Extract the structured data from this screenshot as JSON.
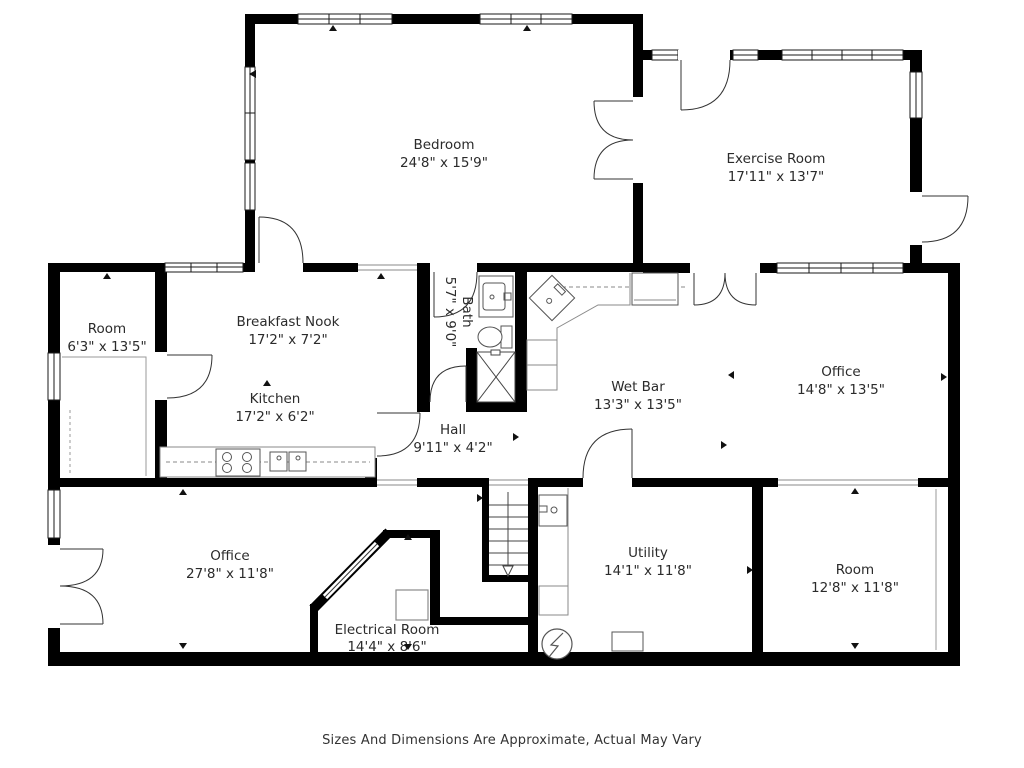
{
  "footer": {
    "disclaimer": "Sizes And Dimensions Are Approximate, Actual May Vary"
  },
  "rooms": {
    "bedroom": {
      "name": "Bedroom",
      "dims": "24'8\" x 15'9\""
    },
    "exercise_room": {
      "name": "Exercise Room",
      "dims": "17'11\" x 13'7\""
    },
    "room_left": {
      "name": "Room",
      "dims": "6'3\" x 13'5\""
    },
    "breakfast_nook": {
      "name": "Breakfast Nook",
      "dims": "17'2\" x 7'2\""
    },
    "kitchen": {
      "name": "Kitchen",
      "dims": "17'2\" x 6'2\""
    },
    "bath": {
      "name": "Bath",
      "dims": "5'7\" x 9'0\""
    },
    "wet_bar": {
      "name": "Wet Bar",
      "dims": "13'3\" x 13'5\""
    },
    "office_middle": {
      "name": "Office",
      "dims": "14'8\" x 13'5\""
    },
    "hall": {
      "name": "Hall",
      "dims": "9'11\" x 4'2\""
    },
    "office_lower": {
      "name": "Office",
      "dims": "27'8\" x 11'8\""
    },
    "electrical_room": {
      "name": "Electrical Room",
      "dims": "14'4\" x 8'6\""
    },
    "utility": {
      "name": "Utility",
      "dims": "14'1\" x 11'8\""
    },
    "room_lower_right": {
      "name": "Room",
      "dims": "12'8\" x 11'8\""
    }
  },
  "colors": {
    "wall": "#000000",
    "background": "#ffffff",
    "label_text": "#2b2b2b",
    "fixture_line": "#555555"
  }
}
